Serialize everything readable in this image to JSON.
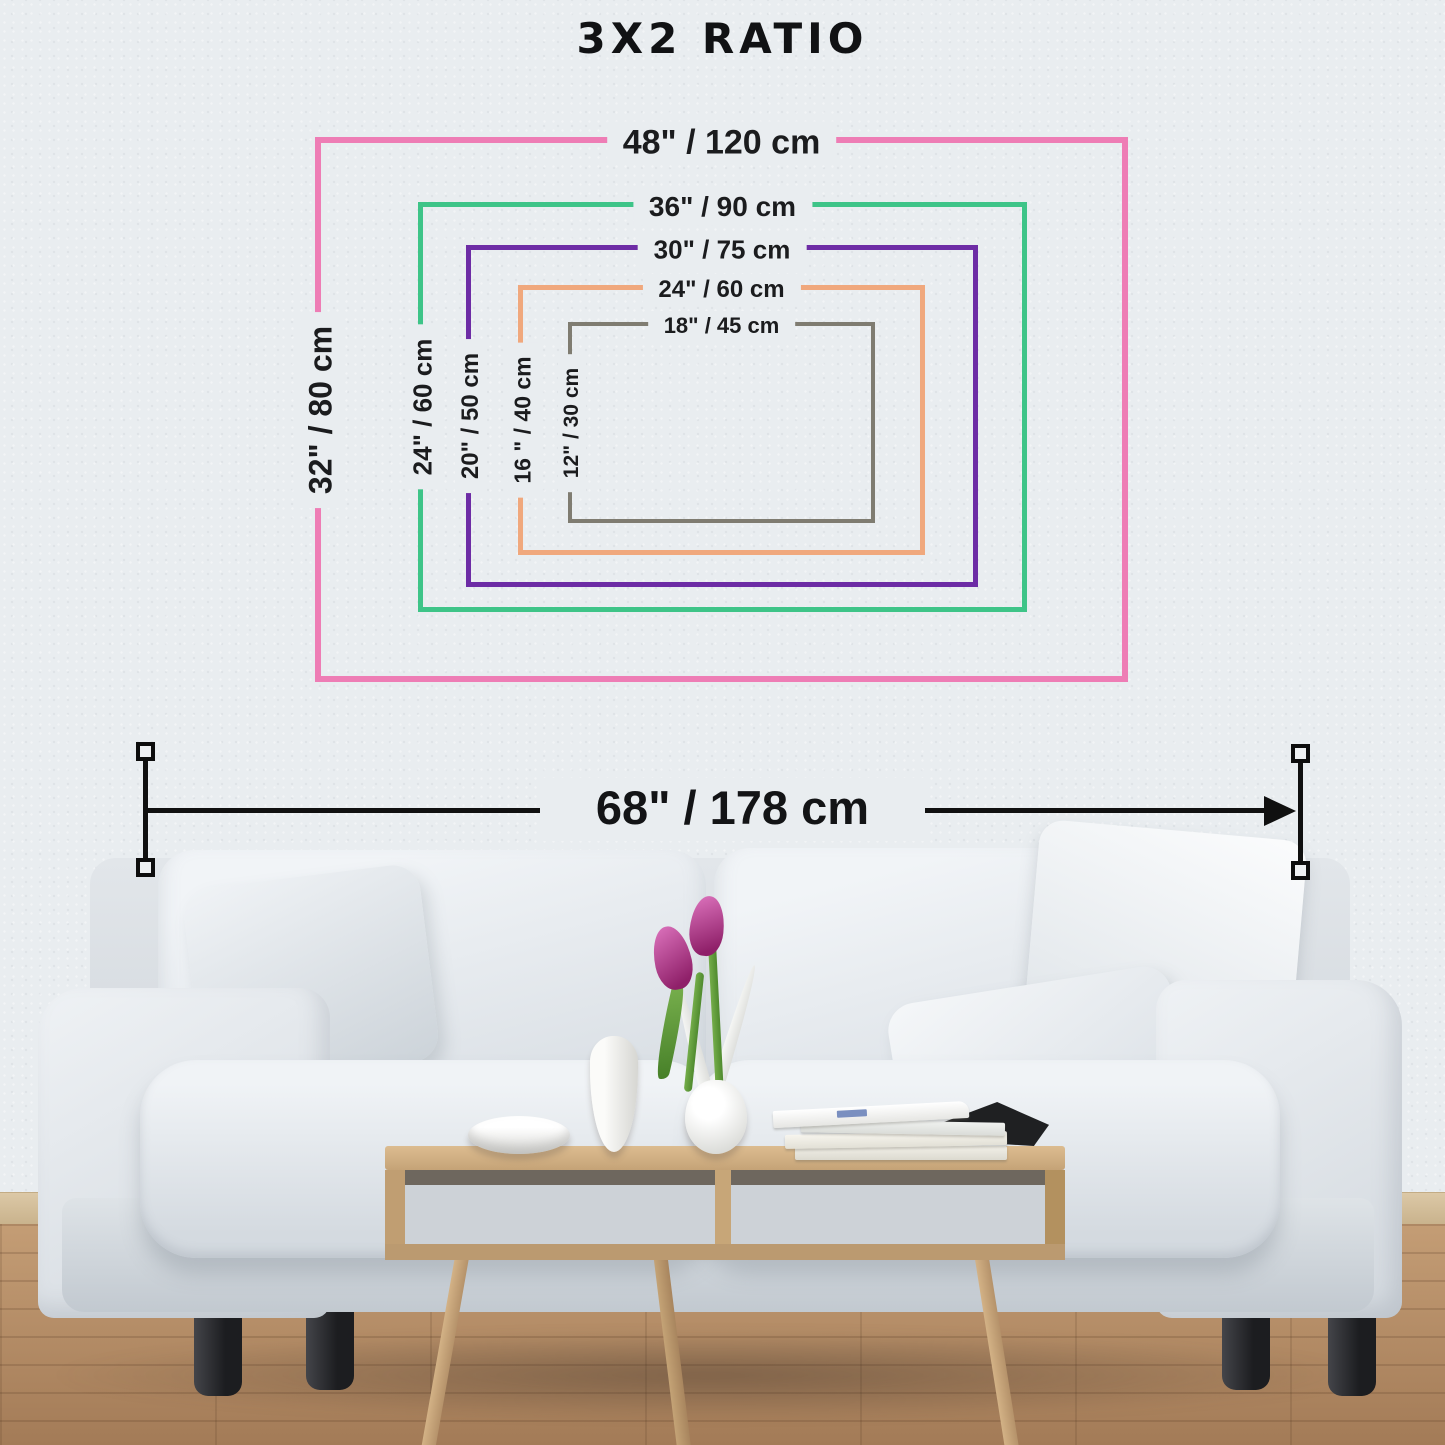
{
  "title": "3X2 RATIO",
  "aspect_ratio": "3x2",
  "wall_color": "#e9edf0",
  "text_color": "#1b1c1e",
  "sizes": [
    {
      "id": "48x32",
      "top_label": "48\" / 120 cm",
      "side_label": "32\" / 80 cm",
      "color": "#ee7db5",
      "color_name": "pink"
    },
    {
      "id": "36x24",
      "top_label": "36\" / 90 cm",
      "side_label": "24\" / 60 cm",
      "color": "#3ec488",
      "color_name": "green"
    },
    {
      "id": "30x20",
      "top_label": "30\" / 75 cm",
      "side_label": "20\" / 50 cm",
      "color": "#6d2ca5",
      "color_name": "purple"
    },
    {
      "id": "24x16",
      "top_label": "24\" / 60 cm",
      "side_label": "16 \" / 40 cm",
      "color": "#f0a87d",
      "color_name": "orange"
    },
    {
      "id": "18x12",
      "top_label": "18\" / 45 cm",
      "side_label": "12\" / 30 cm",
      "color": "#7f7c71",
      "color_name": "gray"
    }
  ],
  "wall_width_dimension": {
    "label": "68\" / 178 cm"
  },
  "scene": {
    "description": "white sofa with pillows, wooden coffee table with bowl, vases, tulips and books, wooden plank floor"
  }
}
